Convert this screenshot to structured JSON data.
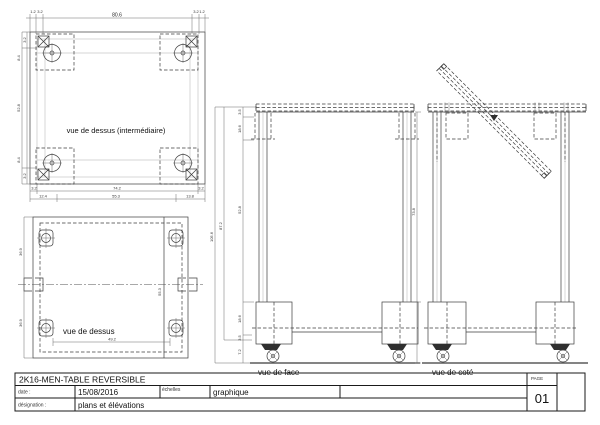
{
  "views": {
    "top_intermediate": {
      "label": "vue de dessus (intermédiaire)"
    },
    "top": {
      "label": "vue de dessus"
    },
    "front": {
      "label": "vue de face"
    },
    "side": {
      "label": "vue de coté"
    }
  },
  "title_block": {
    "drawing_title": "2K16-MEN-TABLE REVERSIBLE",
    "date_label": "date :",
    "date_value": "15/08/2016",
    "scales_label": "échelles",
    "scales_value": "graphique",
    "designation_label": "désignation :",
    "designation_value": "plans et élévations",
    "page_label": "PAGE",
    "page_number": "01"
  },
  "dims": {
    "v1_top": [
      "1.2",
      "3.2",
      "80.6",
      "3.2",
      "1.2"
    ],
    "v1_left": [
      "3.2",
      "8.4",
      "52.8",
      "8.4",
      "3.2"
    ],
    "v1_bottom_row1": [
      "3.2",
      "74.2",
      "3.2"
    ],
    "v1_bottom_row2": [
      "12.4",
      "55.3",
      "13.8"
    ],
    "v2_left": [
      "36.9",
      "36.9"
    ],
    "v2_table_width": "55.3",
    "v2_bottom": "49.2",
    "front_total_height": "105.6",
    "front_frame_height": "87.2",
    "front_chain": [
      "3.5",
      "18.6",
      "52.8",
      "18.6",
      "3.5",
      "7.2"
    ],
    "side_frame_height": "73.8"
  }
}
